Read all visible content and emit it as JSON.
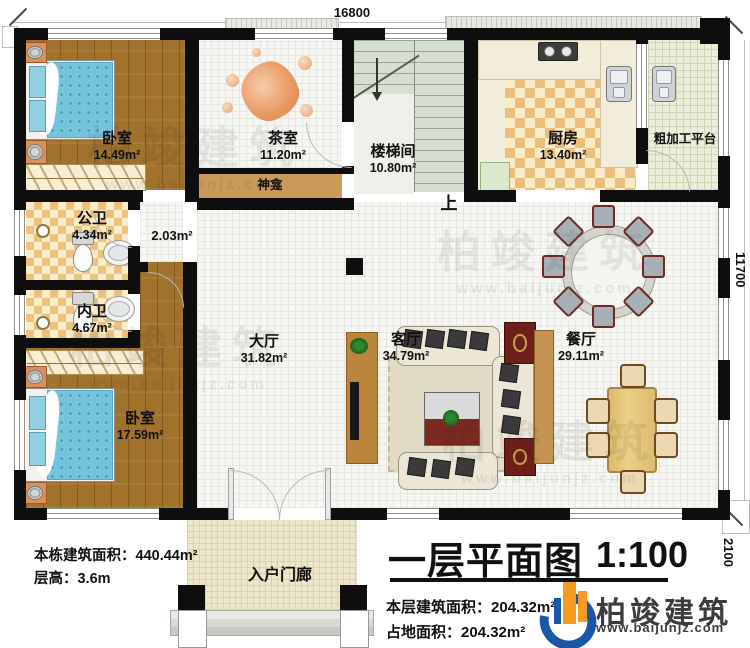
{
  "plan": {
    "dim_top": "16800",
    "dim_right": "11700",
    "dim_right_lower": "2100",
    "up_label": "上",
    "rooms": {
      "bedroom_top": {
        "name": "卧室",
        "area": "14.49m²"
      },
      "tea_room": {
        "name": "茶室",
        "area": "11.20m²"
      },
      "stairwell": {
        "name": "楼梯间",
        "area": "10.80m²"
      },
      "kitchen": {
        "name": "厨房",
        "area": "13.40m²"
      },
      "prep_platform": {
        "name": "粗加工平台"
      },
      "shrine": {
        "name": "神龛"
      },
      "public_bathroom": {
        "name": "公卫",
        "area": "4.34m²"
      },
      "corridor": {
        "area": "2.03m²"
      },
      "inner_bathroom": {
        "name": "内卫",
        "area": "4.67m²"
      },
      "bedroom_bottom": {
        "name": "卧室",
        "area": "17.59m²"
      },
      "hall": {
        "name": "大厅",
        "area": "31.82m²"
      },
      "living_room": {
        "name": "客厅",
        "area": "34.79m²"
      },
      "dining_room": {
        "name": "餐厅",
        "area": "29.11m²"
      },
      "entry_porch": {
        "name": "入户门廊"
      }
    }
  },
  "info_left": {
    "building_area_label": "本栋建筑面积：",
    "building_area_value": "440.44m²",
    "floor_height_label": "层高：",
    "floor_height_value": "3.6m"
  },
  "title_block": {
    "title": "一层平面图",
    "scale": "1:100",
    "floor_area_label": "本层建筑面积：",
    "floor_area_value": "204.32m²",
    "footprint_label": "占地面积：",
    "footprint_value": "204.32m²"
  },
  "brand": {
    "name": "柏竣建筑",
    "website": "www.baijunjz.com"
  },
  "watermark": {
    "name": "柏竣建筑",
    "website": "www.baijunjz.com"
  },
  "colors": {
    "wall": "#0e0e0e",
    "brand_blue": "#1856a6",
    "brand_orange": "#f59b20",
    "wood": "#a0722c"
  }
}
